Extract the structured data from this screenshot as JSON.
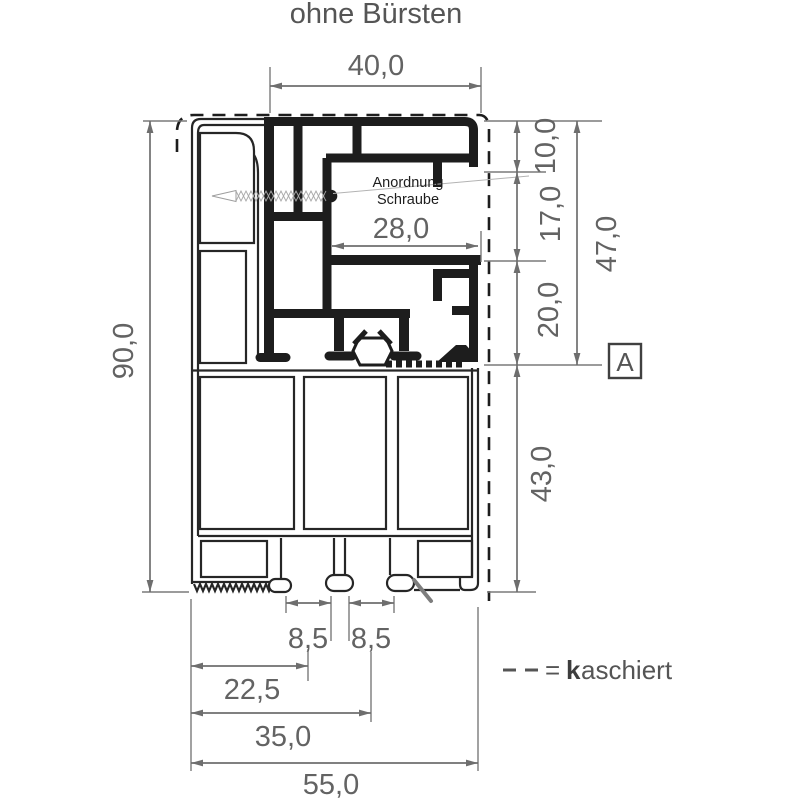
{
  "title": "ohne Bürsten",
  "annotation": {
    "line1": "Anordnung",
    "line2": "Schraube"
  },
  "section_marker": "A",
  "legend": {
    "equals": "=",
    "bold_prefix": "k",
    "suffix": "aschiert"
  },
  "dimensions": {
    "top_width": "40,0",
    "inner_width": "28,0",
    "left_total_height": "90,0",
    "right": {
      "seg1": "10,0",
      "seg2": "17,0",
      "seg3": "20,0",
      "seg4": "43,0",
      "subtotal": "47,0"
    },
    "bottom": {
      "slot1": "8,5",
      "slot2": "8,5",
      "dim1": "22,5",
      "dim2": "35,0",
      "total_width": "55,0"
    }
  },
  "colors": {
    "drawing": "#1d1d1d",
    "dimension_lines": "#6e6e6e",
    "dimension_text": "#636363"
  }
}
